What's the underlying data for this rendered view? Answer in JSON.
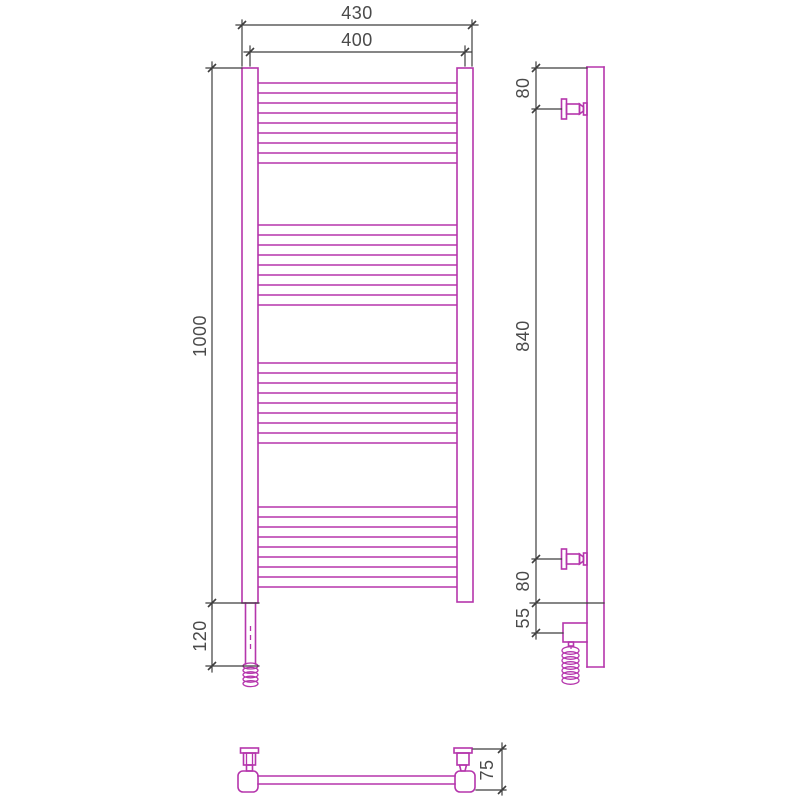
{
  "drawing": {
    "type": "technical-drawing-heated-towel-rail",
    "colors": {
      "outline": "#b535ac",
      "dimension": "#3e3e3e",
      "text": "#4a4a4a",
      "background": "#ffffff"
    },
    "front_view": {
      "dims": {
        "overall_width": "430",
        "axis_width": "400",
        "height": "1000",
        "element_extension": "120"
      },
      "rungs": {
        "groups": 4,
        "lines_per_group": 9
      }
    },
    "side_view": {
      "dims": {
        "top_bracket_offset": "80",
        "bracket_span": "840",
        "bottom_bracket_offset": "80",
        "element_offset": "55"
      }
    },
    "bottom_view": {
      "dims": {
        "wall_distance": "75"
      }
    }
  }
}
